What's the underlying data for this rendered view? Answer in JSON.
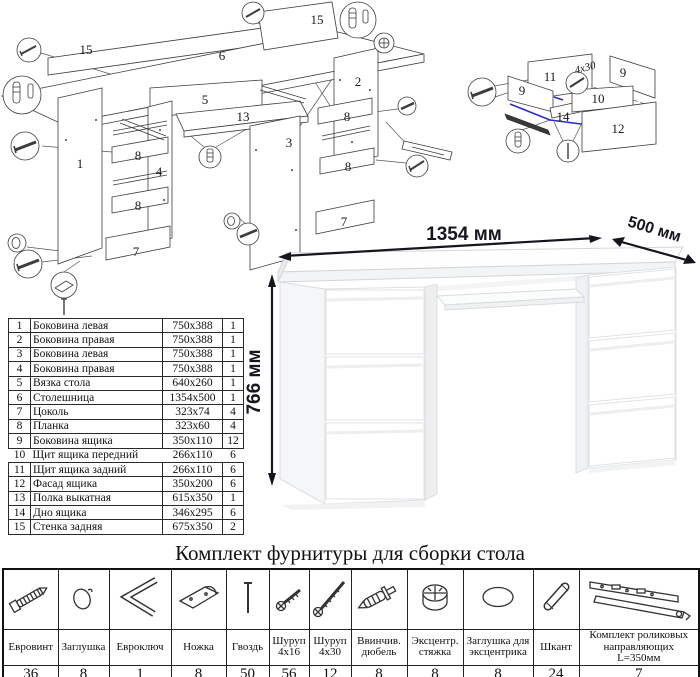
{
  "main_diagram": {
    "labels": [
      "15",
      "6",
      "15",
      "5",
      "13",
      "1",
      "8",
      "4",
      "8",
      "7",
      "2",
      "8",
      "3",
      "8",
      "7"
    ]
  },
  "drawer_diagram": {
    "labels": {
      "back_panel": "11",
      "side_panel_right": "9",
      "side_panel_left": "9",
      "front_panel": "10",
      "bottom_panel": "14",
      "facade": "12",
      "screw_size": "4x30"
    }
  },
  "desk_figure": {
    "width": "1354 мм",
    "depth": "500 мм",
    "height": "766 мм"
  },
  "parts_table": {
    "rows": [
      {
        "num": "1",
        "name": "Боковина левая",
        "size": "750x388",
        "qty": "1"
      },
      {
        "num": "2",
        "name": "Боковина правая",
        "size": "750x388",
        "qty": "1"
      },
      {
        "num": "3",
        "name": "Боковина левая",
        "size": "750x388",
        "qty": "1"
      },
      {
        "num": "4",
        "name": "Боковина правая",
        "size": "750x388",
        "qty": "1"
      },
      {
        "num": "5",
        "name": "Вязка стола",
        "size": "640x260",
        "qty": "1"
      },
      {
        "num": "6",
        "name": "Столешница",
        "size": "1354x500",
        "qty": "1"
      },
      {
        "num": "7",
        "name": "Цоколь",
        "size": "323x74",
        "qty": "4"
      },
      {
        "num": "8",
        "name": "Планка",
        "size": "323x60",
        "qty": "4"
      },
      {
        "num": "9",
        "name": "Боковина ящика",
        "size": "350x110",
        "qty": "12"
      },
      {
        "num": "10",
        "name": "Щит ящика передний",
        "size": "266x110",
        "qty": "6"
      },
      {
        "num": "11",
        "name": "Щит ящика задний",
        "size": "266x110",
        "qty": "6"
      },
      {
        "num": "12",
        "name": "Фасад ящика",
        "size": "350x200",
        "qty": "6"
      },
      {
        "num": "13",
        "name": "Полка выкатная",
        "size": "615x350",
        "qty": "1"
      },
      {
        "num": "14",
        "name": "Дно ящика",
        "size": "346x295",
        "qty": "6"
      },
      {
        "num": "15",
        "name": "Стенка задняя",
        "size": "675x350",
        "qty": "2"
      }
    ]
  },
  "hardware": {
    "title": "Комплект фурнитуры для сборки стола",
    "items": [
      {
        "name": "Евровинт",
        "qty": "36",
        "icon": "euro-screw-icon"
      },
      {
        "name": "Заглушка",
        "qty": "8",
        "icon": "cap-icon"
      },
      {
        "name": "Евроключ",
        "qty": "1",
        "icon": "hex-key-icon"
      },
      {
        "name": "Ножка",
        "qty": "8",
        "icon": "foot-icon"
      },
      {
        "name": "Гвоздь",
        "qty": "50",
        "icon": "nail-icon"
      },
      {
        "name": "Шуруп 4x16",
        "qty": "56",
        "icon": "screw-4x16-icon"
      },
      {
        "name": "Шуруп 4x30",
        "qty": "12",
        "icon": "screw-4x30-icon"
      },
      {
        "name": "Ввинчив. дюбель",
        "qty": "8",
        "icon": "screw-in-dowel-icon"
      },
      {
        "name": "Эксцентр. стяжка",
        "qty": "8",
        "icon": "eccentric-cam-icon"
      },
      {
        "name": "Заглушка для эксцентрика",
        "qty": "8",
        "icon": "cam-cap-icon"
      },
      {
        "name": "Шкант",
        "qty": "24",
        "icon": "wood-dowel-icon"
      },
      {
        "name": "Комплект роликовых направляющих L=350мм",
        "qty": "7",
        "icon": "roller-guides-icon"
      }
    ]
  },
  "colors": {
    "highlight_blue": "#2929d6",
    "dimension": "#16161e",
    "line": "#3d3d3d"
  }
}
